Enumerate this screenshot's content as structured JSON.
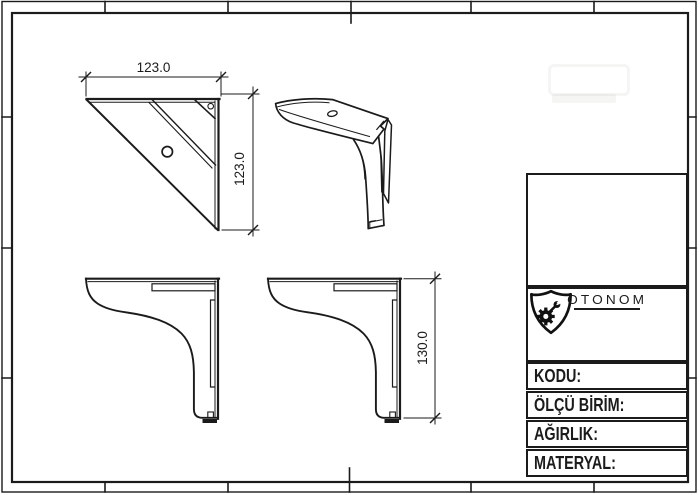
{
  "drawing": {
    "dimensions": {
      "plan_width": "123.0",
      "plan_height": "123.0",
      "side_height": "130.0"
    },
    "title_block": {
      "company": "OTONOM",
      "fields": [
        {
          "label": "KODU:",
          "value": ""
        },
        {
          "label": "ÖLÇÜ BİRİM:",
          "value": ""
        },
        {
          "label": "AĞIRLIK:",
          "value": ""
        },
        {
          "label": "MATERYAL:",
          "value": ""
        }
      ]
    },
    "colors": {
      "line": "#1b1b1b",
      "paper": "#ffffff"
    }
  }
}
